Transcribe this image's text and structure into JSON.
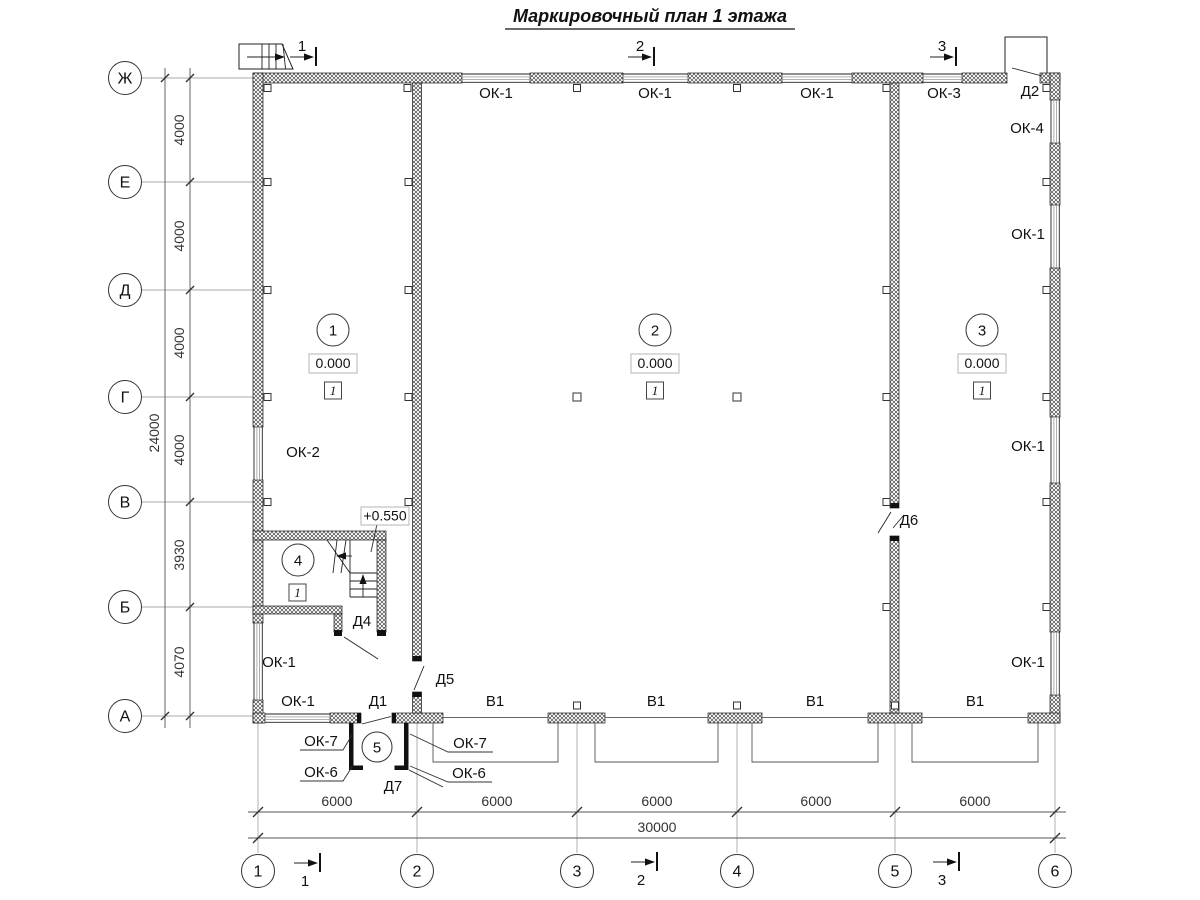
{
  "title": "Маркировочный план 1 этажа",
  "axes": {
    "vertical": [
      "Ж",
      "Е",
      "Д",
      "Г",
      "В",
      "Б",
      "А"
    ],
    "horizontal": [
      "1",
      "2",
      "3",
      "4",
      "5",
      "6"
    ]
  },
  "dimensions": {
    "left_total": "24000",
    "left_segments": [
      "4000",
      "4000",
      "4000",
      "4000",
      "3930",
      "4070"
    ],
    "bottom_segments": [
      "6000",
      "6000",
      "6000",
      "6000",
      "6000"
    ],
    "bottom_total": "30000"
  },
  "section_marks": [
    "1",
    "2",
    "3"
  ],
  "rooms": {
    "room1": {
      "number": "1",
      "elevation": "0.000",
      "finish": "1"
    },
    "room2": {
      "number": "2",
      "elevation": "0.000",
      "finish": "1"
    },
    "room3": {
      "number": "3",
      "elevation": "0.000",
      "finish": "1"
    },
    "room4": {
      "number": "4",
      "finish": "1",
      "landing_elevation": "+0.550"
    },
    "room5": {
      "number": "5"
    }
  },
  "openings": {
    "windows": {
      "ok1": "ОК-1",
      "ok2": "ОК-2",
      "ok3": "ОК-3",
      "ok4": "ОК-4",
      "ok6": "ОК-6",
      "ok7": "ОК-7"
    },
    "doors": {
      "d1": "Д1",
      "d2": "Д2",
      "d4": "Д4",
      "d5": "Д5",
      "d6": "Д6",
      "d7": "Д7"
    },
    "gates": {
      "v1": "В1"
    }
  }
}
